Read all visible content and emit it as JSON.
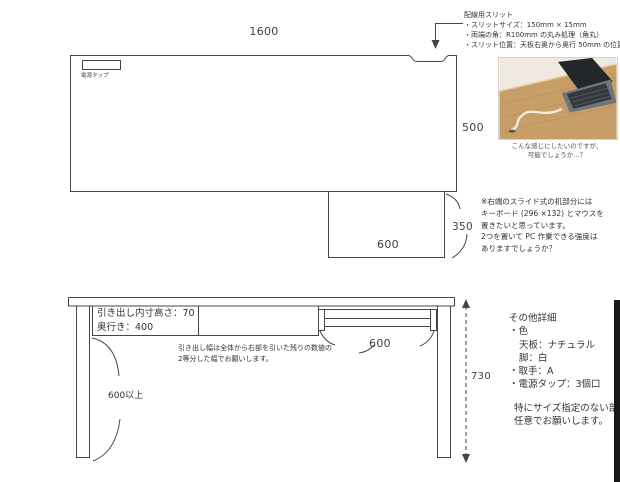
{
  "top_view": {
    "width_dim": "1600",
    "depth_dim": "500",
    "slide_depth_dim": "350",
    "slide_width_dim": "600",
    "power_tap": "電源タップ"
  },
  "slit_note": {
    "title": "配線用スリット",
    "line1": "・スリットサイズ：150mm × 15mm",
    "line2": "・両端の角：R100mm の丸み処理（角丸）",
    "line3": "・スリット位置：天板右奥から奥行 50mm の位置"
  },
  "photo_caption": {
    "line1": "こんな感じにしたいのですが、",
    "line2": "可能でしょうか…？"
  },
  "slide_note": {
    "line1": "※右端のスライド式の机部分には",
    "line2": "キーボード (296 ×132) とマウスを",
    "line3": "置きたいと思っています。",
    "line4": "2つを置いて PC 作業できる強度は",
    "line5": "ありますでしょうか？"
  },
  "front_view": {
    "drawer_inner_height": "引き出し内寸高さ：70",
    "drawer_depth": "奥行き：400",
    "drawer_note_line1": "引き出し幅は全体から右部を引いた残りの数値の",
    "drawer_note_line2": "2等分した幅でお願いします。",
    "clearance": "600以上",
    "tray_width_dim": "600",
    "height_dim": "730"
  },
  "details": {
    "title": "その他詳細",
    "item_color": "・色",
    "item_top": "天板：ナチュラル",
    "item_legs": "脚：白",
    "item_handle": "・取手：A",
    "item_power": "・電源タップ：3個口",
    "footer1": "特にサイズ指定のない部分",
    "footer2": "任意でお願いします。"
  },
  "colors": {
    "line": "#454545",
    "wood": "#c89e68",
    "laptop": "#23262a",
    "edge_bar": "#181818"
  }
}
